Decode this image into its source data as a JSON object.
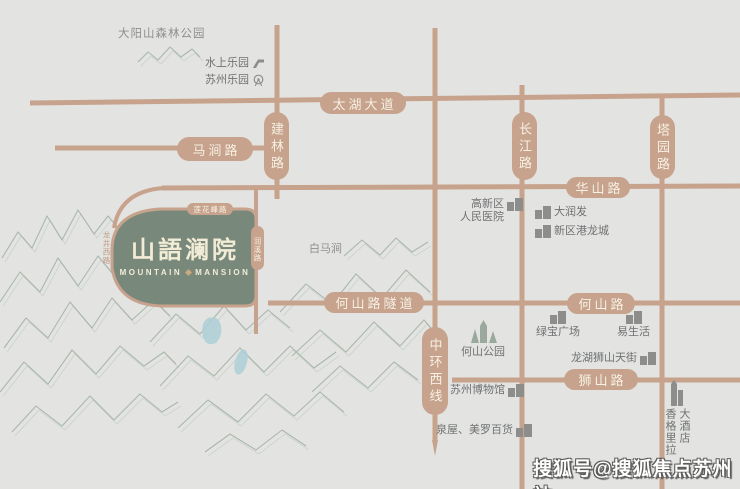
{
  "meta": {
    "background_color": "#e3e4e1",
    "road_color": "#c7a28c",
    "pill_text_color": "#f6f1e4",
    "plot_color": "#78897c",
    "lake_color": "#aed0d8",
    "mountain_sketch_color": "#a7b4ab",
    "watermark_color": "#ffffff"
  },
  "project": {
    "title_cn": "山語澜院",
    "title_en_1": "MOUNTAIN",
    "title_en_2": "MANSION"
  },
  "roads": {
    "taihu_avenue": "太湖大道",
    "majian_road": "马涧路",
    "jianlin_road": "建林路",
    "changjiang_road": "长江路",
    "tayuan_road": "塔园路",
    "huashan_road": "华山路",
    "heshan_tunnel": "何山路隧道",
    "heshan_road": "何山路",
    "shishan_road": "狮山路",
    "zhonghuan_west_line": "中环西线",
    "lianhuafeng_road": "莲花峰路",
    "west_side_road": "龙井西路",
    "east_side_road": "润溪路"
  },
  "pois": {
    "dayangshan_forest_park": "大阳山森林公园",
    "water_park": "水上乐园",
    "suzhou_amusement_park": "苏州乐园",
    "hospital_line1": "高新区",
    "hospital_line2": "人民医院",
    "rt_mart": "大润发",
    "ganglong_city": "新区港龙城",
    "baimajian": "白马涧",
    "heshan_park": "何山公园",
    "lvbao_plaza": "绿宝广场",
    "yi_life": "易生活",
    "longhu_shishan_street": "龙湖狮山天街",
    "suzhou_museum": "苏州博物馆",
    "quanwu_meiluo": "泉屋、美罗百货",
    "shangrila_col1": "香格里拉",
    "shangrila_col2": "大酒店"
  },
  "watermark": "搜狐号@搜狐焦点苏州站"
}
